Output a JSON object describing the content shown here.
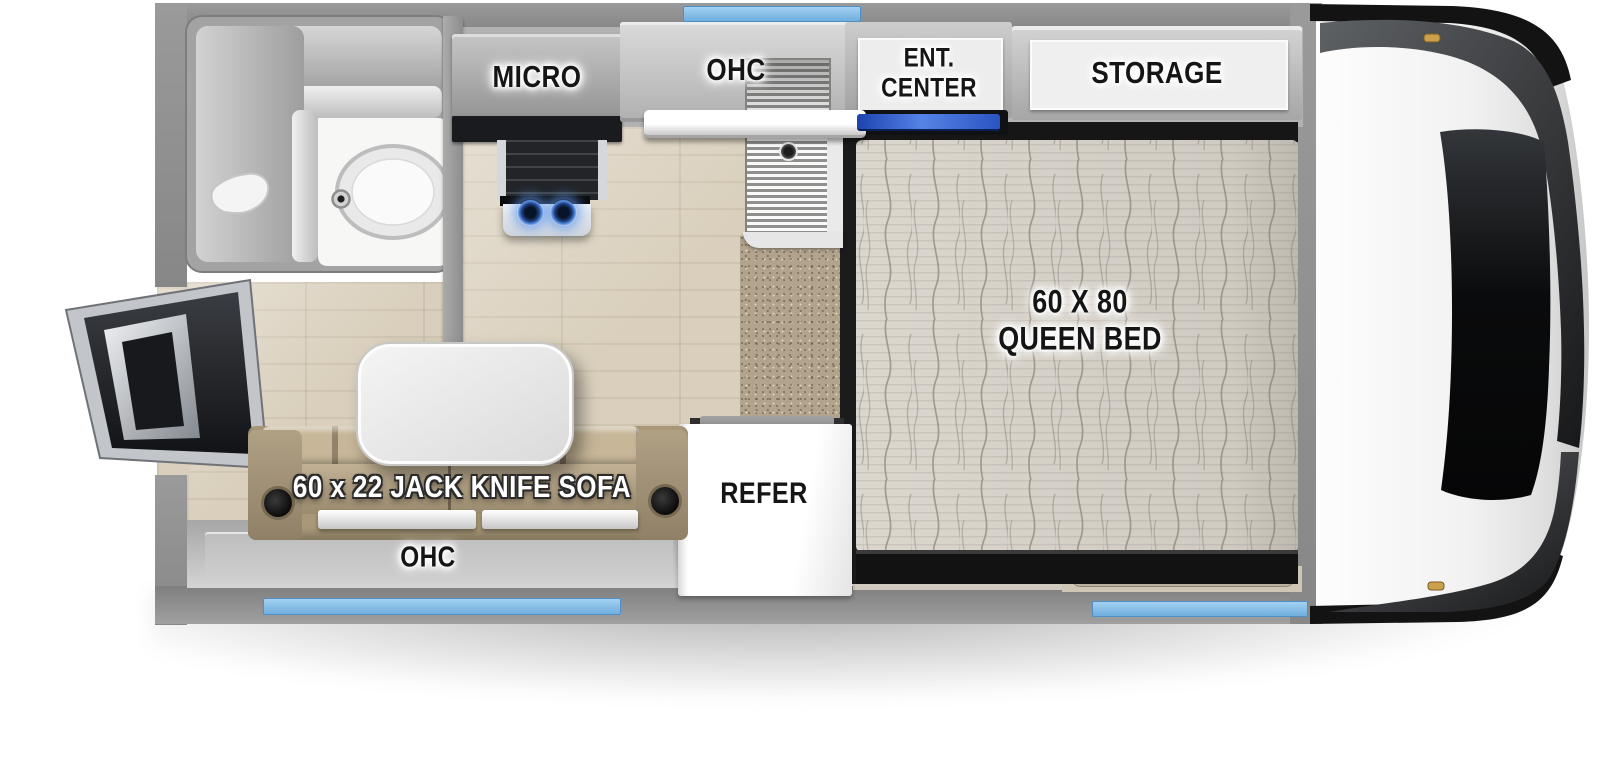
{
  "title": "Truck camper floor plan",
  "colors": {
    "accent_blue": "#7fb8e8",
    "wall_gray": "#8e8e8e",
    "floor_wood": "#d9cfbc",
    "carpet_step": "#b2a38d",
    "sofa_tan": "#a89878",
    "mattress": "#dcd7ce",
    "tv_blue": "#3a63cf",
    "burner_blue": "#5d95ea"
  },
  "labels": {
    "micro": "MICRO",
    "kitchen_ohc": "OHC",
    "ent_center_line1": "ENT.",
    "ent_center_line2": "CENTER",
    "storage": "STORAGE",
    "bed_line1": "60 X 80",
    "bed_line2": "QUEEN BED",
    "refer": "REFER",
    "sofa": "60 x 22 JACK KNIFE SOFA",
    "rear_ohc": "OHC"
  }
}
